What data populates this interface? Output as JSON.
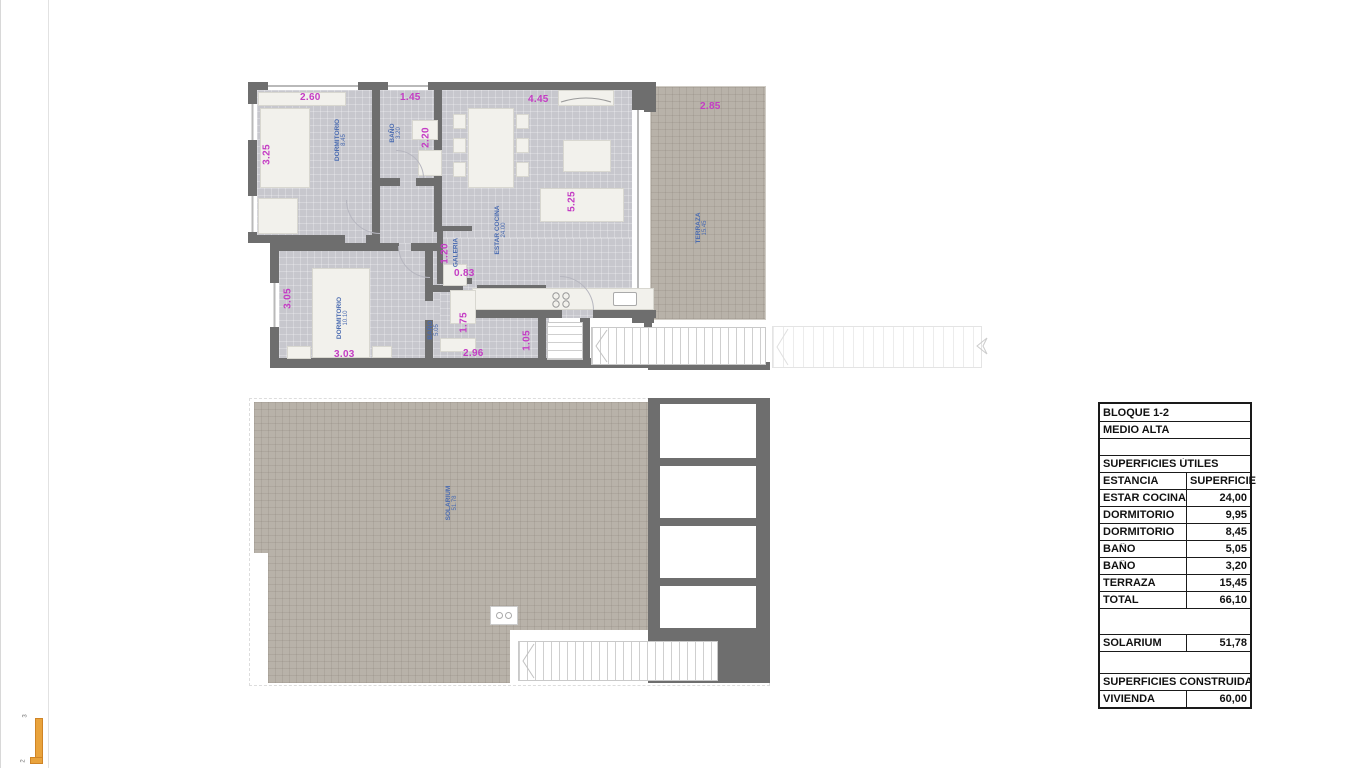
{
  "colors": {
    "wall": "#6e6e6e",
    "interior_floor": "#c7c7cd",
    "tile": "#b8b2a9",
    "dimension_text": "#c43cc4",
    "room_label_text": "#4a6bb0",
    "accent_orange": "#e9a33c"
  },
  "plan_upper": {
    "rooms": {
      "dorm1": {
        "name": "DORMITORIO",
        "area": "8.45"
      },
      "bano1": {
        "name": "BAÑO",
        "area": "3.20"
      },
      "estar": {
        "name": "ESTAR COCINA",
        "area": "24.00"
      },
      "galeria": {
        "name": "GALERIA",
        "area": ""
      },
      "dorm2": {
        "name": "DORMITORIO",
        "area": "10.10"
      },
      "bano2": {
        "name": "BAÑO",
        "area": "5.05"
      },
      "terraza": {
        "name": "TERRAZA",
        "area": "15.45"
      }
    },
    "dims": {
      "top_dorm1": "2.60",
      "top_bano1": "1.45",
      "top_estar": "4.45",
      "top_terraza": "2.85",
      "left_dorm1": "3.25",
      "right_bano1": "2.20",
      "right_estar": "5.25",
      "left_dorm2": "3.05",
      "galeria_h": "1.20",
      "galeria_w": "0.83",
      "bottom_dorm2": "3.03",
      "bano2_h": "1.75",
      "bano2_w": "2.96",
      "stairs_w": "1.05"
    }
  },
  "plan_lower": {
    "solarium": {
      "name": "SOLARIUM",
      "area": "51.78"
    }
  },
  "table": {
    "title_block": "BLOQUE 1-2",
    "subtitle": "MEDIO ALTA",
    "section_utiles": "SUPERFICIES ÚTILES",
    "header": {
      "estancia": "ESTANCIA",
      "superficie": "SUPERFICIE"
    },
    "rows": [
      {
        "label": "ESTAR COCINA",
        "value": "24,00"
      },
      {
        "label": "DORMITORIO",
        "value": "9,95"
      },
      {
        "label": "DORMITORIO",
        "value": "8,45"
      },
      {
        "label": "BAÑO",
        "value": "5,05"
      },
      {
        "label": "BAÑO",
        "value": "3,20"
      },
      {
        "label": "TERRAZA",
        "value": "15,45"
      },
      {
        "label": "TOTAL",
        "value": "66,10"
      }
    ],
    "solarium_row": {
      "label": "SOLARIUM",
      "value": "51,78"
    },
    "section_construidas": "SUPERFICIES CONSTRUIDAS",
    "vivienda_row": {
      "label": "VIVIENDA",
      "value": "60,00"
    }
  },
  "margin_marks": {
    "top": "3",
    "bottom": "2"
  }
}
